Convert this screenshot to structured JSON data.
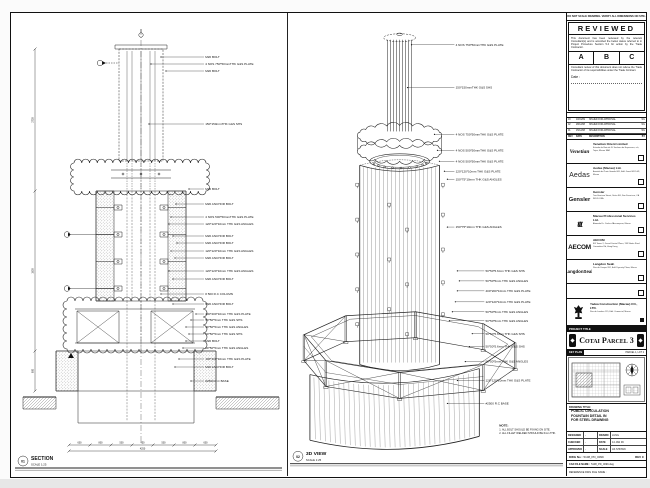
{
  "page": {
    "bg": "#fbfbfb",
    "sheet_bg": "#ffffff",
    "line_color": "#1a1a1a"
  },
  "views": {
    "section": {
      "num": "01",
      "label": "SECTION",
      "scale": "SCALE 1:25",
      "callouts": [
        "M20 BOLT",
        "4 NOS 750*50mmTHK G&S PLATE",
        "M20 BOLT",
        "150*150mmTHK G&S SHS",
        "M20 BOLT",
        "M20 ANCHOR BOLT",
        "4 NOS 500*50mmTHK G&S PLATE",
        "120*120*10mm THK G&S ANGLES",
        "M20 ANCHOR BOLT",
        "M20 ANCHOR BOLT",
        "120*120*10mm THK G&S ANGLES",
        "M20 ANCHOR BOLT",
        "120*120*10mm THK G&S ANGLES",
        "M20 ANCHOR BOLT",
        "# 500 R.C COLUMN",
        "M20 ANCHOR BOLT",
        "400*200*10mm THK G&S PLATE",
        "50*50*5mm THK G&S SHS",
        "50*50*5mm THK G&S ANGLES",
        "50*50*5mm THK G&S SHS",
        "M20 BOLT",
        "50*50*5mm THK G&S ANGLES",
        "100*100*10mm THK G&S PLATE",
        "M20 ANCHOR BOLT",
        "#2500 R.C BASE"
      ],
      "dims_left": [
        "2700",
        "1800",
        "800"
      ],
      "dims_bottom": [
        "600",
        "800",
        "500",
        "450",
        "500",
        "800",
        "600"
      ],
      "dim_total": "4250"
    },
    "iso": {
      "num": "02",
      "label": "3D VIEW",
      "scale": "SCALE 1:25",
      "callouts": [
        "4 NOS 750*50mmTHK G&S PLATE",
        "150*150mmTHK G&S SHS",
        "4 NOS 750*50mmTHK G&S PLATE",
        "4 NOS 500*50mmTHK G&S PLATE",
        "4 NOS 500*50mmTHK G&S PLATE",
        "120*120*10mm THK G&S PLATE",
        "150*75*10mm THK G&S ANGLES",
        "150*75*10mm THK G&S ANGLES",
        "50*50*5.6mm THK G&S SHS",
        "50*50*5mm THK G&S ANGLES",
        "400*200*10mm THK G&S PLATE",
        "120*120*10mm THK G&S PLATE",
        "50*50*5mm THK G&S ANGLES",
        "50*50*5mm THK G&S ANGLES",
        "50*50*5.6mm THK G&S SHS",
        "50*50*5.6mm THK G&S SHS",
        "50*50*5mm THK G&S ANGLES",
        "120*120*10mm THK G&S PLATE",
        "#2500 R.C BASE"
      ],
      "note_title": "NOTE:",
      "notes": [
        "1. ALL BOLT SHOULD BE FIXING ON SITE.",
        "2. ALL FILLET WELDED SHOULD BE 6mm THK."
      ]
    }
  },
  "title_block": {
    "top_note": "DO NOT SCALE DRAWING. VERIFY ALL DIMENSIONS ON SITE.",
    "reviewed": {
      "title": "REVIEWED",
      "para1": "This document has been reviewed by the relevant Consultant(s) and is accorded the below status referred to in Project Procedure Section 5.4 for action by the Trade Contractor.",
      "options": [
        "A",
        "B",
        "C"
      ],
      "para2": "Consultant review of this document does not relieve the Trade Contractor of its responsibilities under the Trade Contract.",
      "date_label": "Date :"
    },
    "revisions": {
      "headers": [
        "REV",
        "DATE",
        "DESCRIPTION",
        "BY"
      ],
      "rows": [
        [
          "03",
          "10/01/09",
          "ISSUED FOR APPROVAL",
          "WL"
        ],
        [
          "02",
          "28/12/08",
          "ISSUED FOR APPROVAL",
          "WL"
        ],
        [
          "01",
          "15/12/08",
          "ISSUED FOR APPROVAL",
          "WL"
        ]
      ]
    },
    "companies": [
      {
        "logo": "Venetian",
        "name": "Venetian Orient Limited",
        "address": "Estrada da Baia de N. Senhora da Esperanca, s/n, Taipa, Macau SAR"
      },
      {
        "logo": "Aedas",
        "name": "Aedas (Macau) Ltd.",
        "address": "Avenida da Praia Grande 665, Edif. Great Will 14/F, Macau"
      },
      {
        "logo": "Gensler",
        "name": "Gensler",
        "address": "Two Harrison Street, Suite 400, San Francisco, CA 94105 USA"
      },
      {
        "logo": "ttt",
        "name": "Macau Professional Services Ltd.",
        "address": "Alameda Dr. Carlos d'Assumpcao, Macau"
      },
      {
        "logo": "AECOM",
        "name": "AECOM",
        "address": "8/F Tower 2, Grand Central Plaza, 138 Shatin Rural Committee Rd, Hong Kong"
      },
      {
        "logo": "LangdonSeah",
        "name": "Langdon Seah",
        "address": "Rua do Campo 202, Edif. Dynasty Plaza, Macau"
      }
    ],
    "contractor": {
      "name": "Yadea Construction (Macau) CO., LTD.",
      "address": "Rua de Londres 115, Edif. Comercial, Macau"
    },
    "project_label": "PROJECT TITLE",
    "project_title": "Cotai Parcel 3",
    "key_plan_label": "KEY PLAN",
    "key_plan_ref": "PARCEL 1, LOT 2",
    "drawing_title_label": "DRAWING TITLE:",
    "drawing_title_lines": [
      "PUBLIC CIRCULATION",
      "FOUNTAIN DETAIL IN",
      "FOR STEEL DRAWING"
    ],
    "fields": [
      [
        "DESIGNED",
        "-",
        "DRAWN",
        "LUNG"
      ],
      [
        "CHECKED",
        "-",
        "DATE",
        "14 JAN 09"
      ],
      [
        "APPROVED",
        "-",
        "SCALE",
        "AS SHOWN"
      ]
    ],
    "dwg_no_label": "DWG No :",
    "dwg_no": "5108_PD_0099",
    "rev_label": "REV",
    "rev": "C",
    "cad_label": "CAD FILE NAME :",
    "cad_file": "5108_PD_0099.dwg",
    "ref_label": "REFERENCE DWG FILE NAME :"
  }
}
